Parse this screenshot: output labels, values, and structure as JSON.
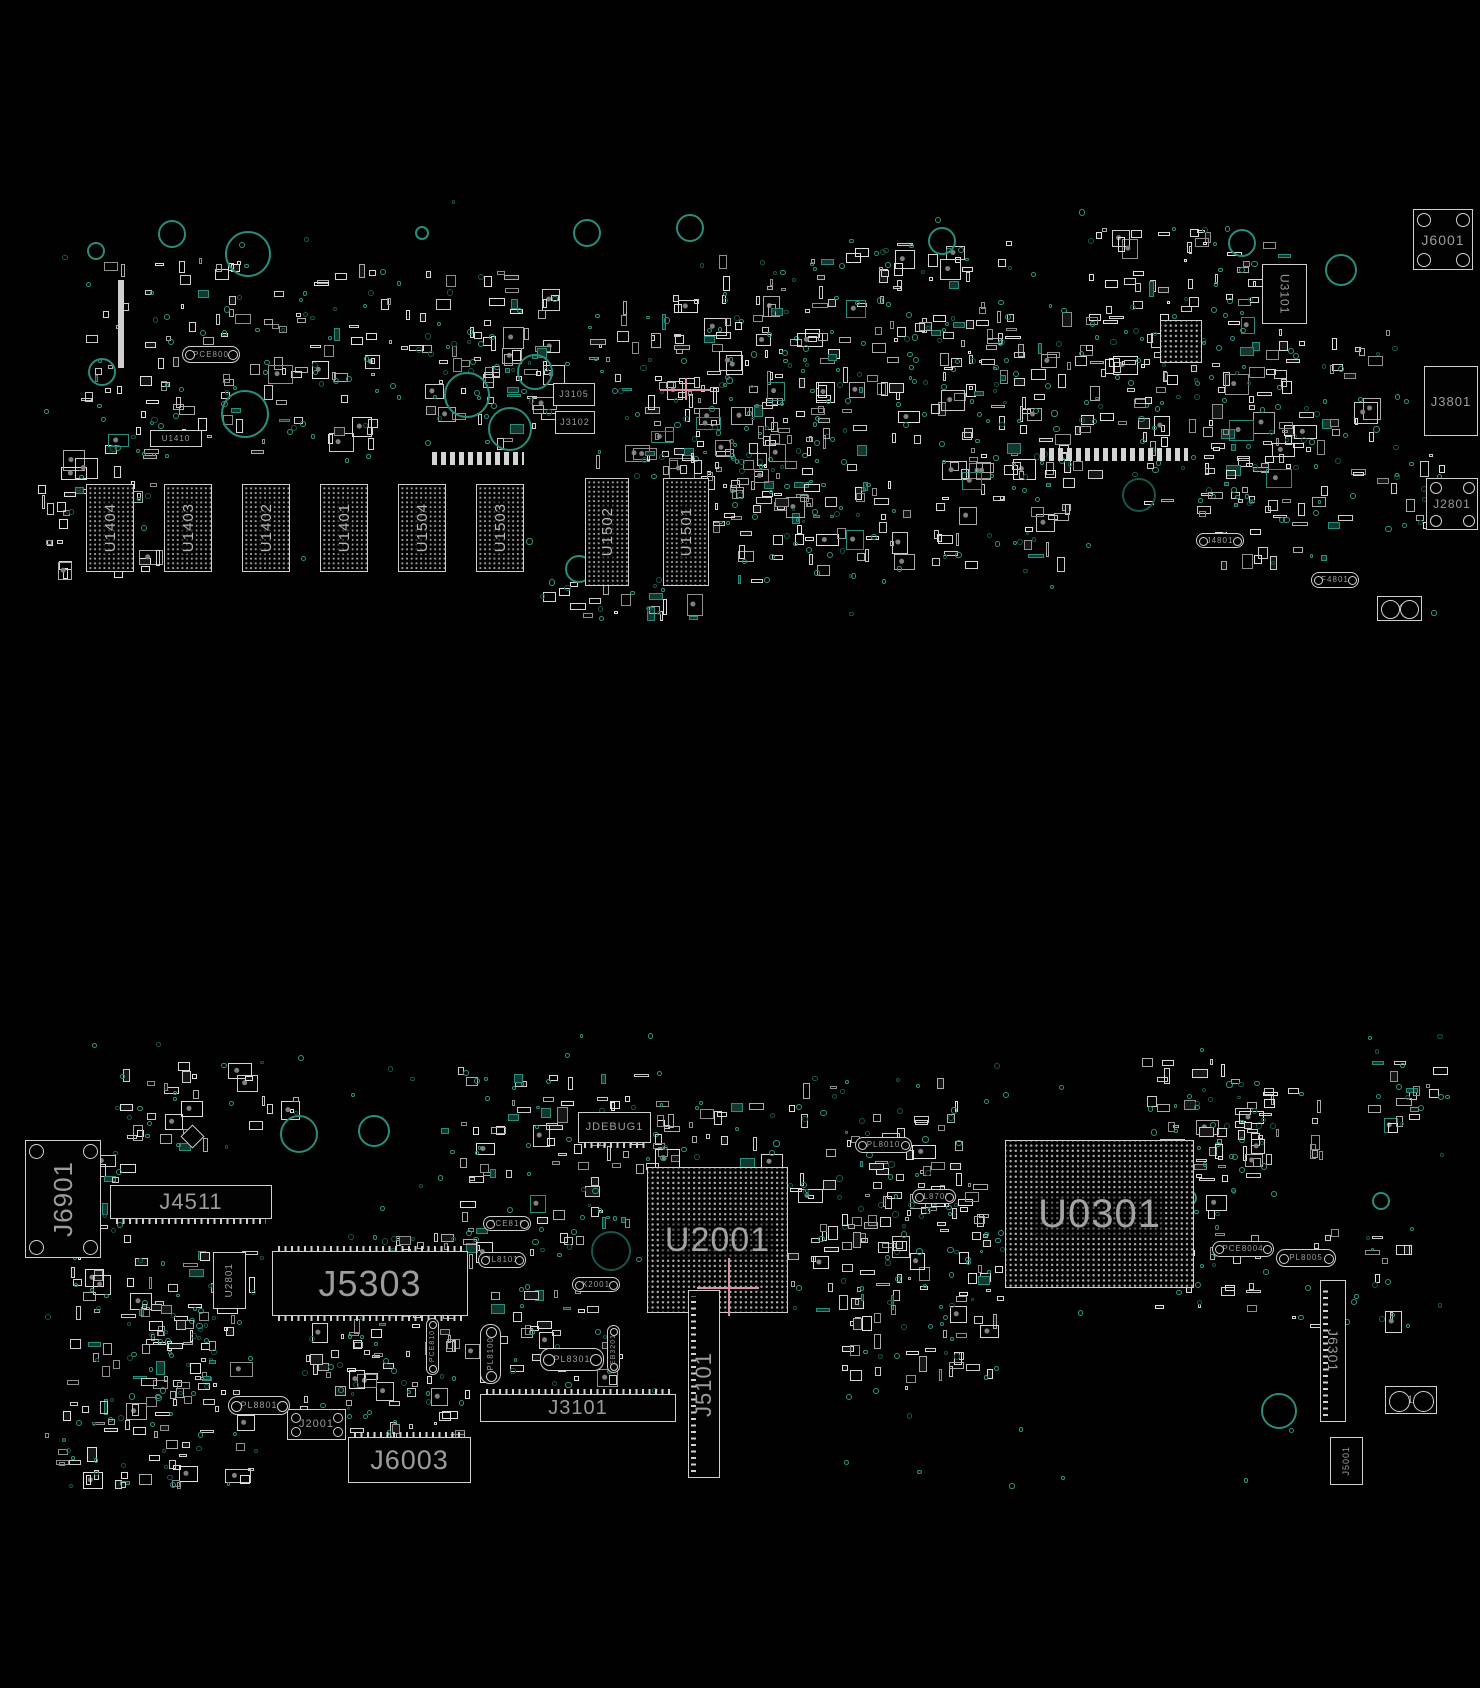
{
  "meta": {
    "background": "#010101",
    "image_kind": "pcb-boardview-two-sides"
  },
  "colors": {
    "silkscreen": "#cfcfcf",
    "label_gray": "#9c9c9c",
    "label_bright": "#b6b6b6",
    "via_teal": "#2f9482",
    "via_teal_dark": "#17564a",
    "hole_teal": "#2a8c7a",
    "crosshair_pink": "#d893a0",
    "background": "#010101"
  },
  "scatter_seed": 42,
  "boards": [
    {
      "name": "top-board-view",
      "components": [
        {
          "label": "J6001",
          "t": "sock",
          "x": 1413,
          "y": 209,
          "w": 60,
          "h": 61,
          "s": 14,
          "dir": "h"
        },
        {
          "label": "U3101",
          "t": "box",
          "x": 1262,
          "y": 264,
          "w": 45,
          "h": 60,
          "s": 12,
          "dir": "vd"
        },
        {
          "label": "",
          "t": "bga",
          "x": 1160,
          "y": 320,
          "w": 42,
          "h": 43,
          "s": 0,
          "dir": "h"
        },
        {
          "label": "J3801",
          "t": "box",
          "x": 1424,
          "y": 366,
          "w": 54,
          "h": 70,
          "s": 13,
          "dir": "h"
        },
        {
          "label": "J2801",
          "t": "sock",
          "x": 1426,
          "y": 478,
          "w": 52,
          "h": 52,
          "s": 12,
          "dir": "h"
        },
        {
          "label": "F4801",
          "t": "oval",
          "x": 1311,
          "y": 572,
          "w": 48,
          "h": 16,
          "s": 8,
          "dir": "h"
        },
        {
          "label": "HP404",
          "t": "jack",
          "x": 1377,
          "y": 596,
          "w": 45,
          "h": 25,
          "s": 10,
          "dir": "h"
        },
        {
          "label": "J4801",
          "t": "oval",
          "x": 1196,
          "y": 533,
          "w": 48,
          "h": 15,
          "s": 8,
          "dir": "h"
        },
        {
          "label": "PCE800",
          "t": "oval",
          "x": 182,
          "y": 346,
          "w": 58,
          "h": 17,
          "s": 8,
          "dir": "h"
        },
        {
          "label": "U1410",
          "t": "box",
          "x": 150,
          "y": 430,
          "w": 52,
          "h": 17,
          "s": 8,
          "dir": "h"
        },
        {
          "label": "J3105",
          "t": "box",
          "x": 553,
          "y": 383,
          "w": 42,
          "h": 23,
          "s": 9,
          "dir": "h"
        },
        {
          "label": "J3102",
          "t": "box",
          "x": 555,
          "y": 411,
          "w": 40,
          "h": 23,
          "s": 9,
          "dir": "h"
        },
        {
          "label": "U1404",
          "t": "mem",
          "x": 86,
          "y": 484,
          "w": 48,
          "h": 88,
          "s": 15,
          "dir": "v"
        },
        {
          "label": "U1403",
          "t": "mem",
          "x": 164,
          "y": 484,
          "w": 48,
          "h": 88,
          "s": 15,
          "dir": "v"
        },
        {
          "label": "U1402",
          "t": "mem",
          "x": 242,
          "y": 484,
          "w": 48,
          "h": 88,
          "s": 15,
          "dir": "v"
        },
        {
          "label": "U1401",
          "t": "mem",
          "x": 320,
          "y": 484,
          "w": 48,
          "h": 88,
          "s": 15,
          "dir": "v"
        },
        {
          "label": "U1504",
          "t": "mem",
          "x": 398,
          "y": 484,
          "w": 48,
          "h": 88,
          "s": 15,
          "dir": "v"
        },
        {
          "label": "U1503",
          "t": "mem",
          "x": 476,
          "y": 484,
          "w": 48,
          "h": 88,
          "s": 15,
          "dir": "v"
        },
        {
          "label": "U1502",
          "t": "mem",
          "x": 585,
          "y": 478,
          "w": 44,
          "h": 108,
          "s": 15,
          "dir": "v"
        },
        {
          "label": "U1501",
          "t": "mem",
          "x": 663,
          "y": 478,
          "w": 46,
          "h": 108,
          "s": 15,
          "dir": "v"
        },
        {
          "label": "",
          "t": "bar",
          "x": 118,
          "y": 280,
          "w": 6,
          "h": 88,
          "s": 0,
          "dir": "h"
        },
        {
          "label": "",
          "t": "pinstrip",
          "x": 432,
          "y": 452,
          "w": 92,
          "h": 13,
          "s": 0,
          "dir": "h"
        },
        {
          "label": "",
          "t": "pinstrip",
          "x": 1040,
          "y": 448,
          "w": 148,
          "h": 13,
          "s": 0,
          "dir": "h"
        },
        {
          "label": "",
          "t": "cross",
          "x": 660,
          "y": 378,
          "w": 50,
          "h": 22,
          "s": 0,
          "dir": "h"
        }
      ],
      "holes": [
        {
          "x": 94,
          "y": 249,
          "r": 7
        },
        {
          "x": 170,
          "y": 232,
          "r": 12
        },
        {
          "x": 246,
          "y": 252,
          "r": 21
        },
        {
          "x": 420,
          "y": 231,
          "r": 5
        },
        {
          "x": 533,
          "y": 370,
          "r": 16
        },
        {
          "x": 585,
          "y": 231,
          "r": 12
        },
        {
          "x": 688,
          "y": 226,
          "r": 12
        },
        {
          "x": 940,
          "y": 239,
          "r": 12
        },
        {
          "x": 1240,
          "y": 241,
          "r": 12
        },
        {
          "x": 1339,
          "y": 268,
          "r": 14
        },
        {
          "x": 100,
          "y": 370,
          "r": 12
        },
        {
          "x": 243,
          "y": 412,
          "r": 22
        },
        {
          "x": 465,
          "y": 393,
          "r": 21
        },
        {
          "x": 508,
          "y": 427,
          "r": 20
        },
        {
          "x": 577,
          "y": 567,
          "r": 12
        },
        {
          "x": 1137,
          "y": 493,
          "r": 15,
          "dark": true
        }
      ],
      "clusters": [
        {
          "x": 80,
          "y": 255,
          "w": 300,
          "h": 210,
          "n": 100,
          "v": 50
        },
        {
          "x": 360,
          "y": 270,
          "w": 200,
          "h": 130,
          "n": 45,
          "v": 20
        },
        {
          "x": 425,
          "y": 325,
          "w": 140,
          "h": 125,
          "n": 28,
          "v": 14
        },
        {
          "x": 588,
          "y": 295,
          "w": 260,
          "h": 185,
          "n": 85,
          "v": 45
        },
        {
          "x": 685,
          "y": 380,
          "w": 185,
          "h": 145,
          "n": 45,
          "v": 28
        },
        {
          "x": 838,
          "y": 235,
          "w": 190,
          "h": 210,
          "n": 60,
          "v": 32
        },
        {
          "x": 928,
          "y": 295,
          "w": 265,
          "h": 185,
          "n": 90,
          "v": 45
        },
        {
          "x": 1085,
          "y": 225,
          "w": 215,
          "h": 170,
          "n": 60,
          "v": 28
        },
        {
          "x": 1125,
          "y": 355,
          "w": 180,
          "h": 155,
          "n": 45,
          "v": 22
        },
        {
          "x": 38,
          "y": 445,
          "w": 125,
          "h": 135,
          "n": 32,
          "v": 14
        },
        {
          "x": 690,
          "y": 435,
          "w": 125,
          "h": 150,
          "n": 38,
          "v": 20
        },
        {
          "x": 790,
          "y": 478,
          "w": 125,
          "h": 105,
          "n": 22,
          "v": 12
        },
        {
          "x": 928,
          "y": 455,
          "w": 170,
          "h": 125,
          "n": 32,
          "v": 16
        },
        {
          "x": 1188,
          "y": 438,
          "w": 145,
          "h": 135,
          "n": 30,
          "v": 15
        },
        {
          "x": 538,
          "y": 578,
          "w": 165,
          "h": 45,
          "n": 16,
          "v": 9
        },
        {
          "x": 1278,
          "y": 328,
          "w": 125,
          "h": 125,
          "n": 22,
          "v": 11
        },
        {
          "x": 700,
          "y": 255,
          "w": 140,
          "h": 120,
          "n": 30,
          "v": 16
        },
        {
          "x": 1300,
          "y": 440,
          "w": 170,
          "h": 90,
          "n": 18,
          "v": 10
        },
        {
          "x": 35,
          "y": 195,
          "w": 1410,
          "h": 430,
          "n": 0,
          "v": 70
        }
      ]
    },
    {
      "name": "bottom-board-view",
      "components": [
        {
          "label": "J6901",
          "t": "sock",
          "x": 25,
          "y": 1140,
          "w": 76,
          "h": 118,
          "s": 26,
          "dir": "v"
        },
        {
          "label": "J4511",
          "t": "connh",
          "x": 110,
          "y": 1185,
          "w": 162,
          "h": 34,
          "s": 22,
          "dir": "h",
          "ticks": "bot"
        },
        {
          "label": "U2801",
          "t": "box",
          "x": 213,
          "y": 1252,
          "w": 33,
          "h": 57,
          "s": 10,
          "dir": "v"
        },
        {
          "label": "J5303",
          "t": "connh",
          "x": 272,
          "y": 1251,
          "w": 196,
          "h": 65,
          "s": 36,
          "dir": "h",
          "ticks": "topbot"
        },
        {
          "label": "JDEBUG1",
          "t": "connh",
          "x": 578,
          "y": 1112,
          "w": 73,
          "h": 31,
          "s": 11,
          "dir": "h",
          "ticks": "bot"
        },
        {
          "label": "U2001",
          "t": "bga",
          "x": 647,
          "y": 1167,
          "w": 141,
          "h": 146,
          "s": 34,
          "dir": "h"
        },
        {
          "label": "U0301",
          "t": "bga",
          "x": 1005,
          "y": 1140,
          "w": 189,
          "h": 148,
          "s": 40,
          "dir": "h"
        },
        {
          "label": "PL8010",
          "t": "oval",
          "x": 855,
          "y": 1137,
          "w": 57,
          "h": 16,
          "s": 8,
          "dir": "h"
        },
        {
          "label": "PL8700",
          "t": "oval",
          "x": 912,
          "y": 1189,
          "w": 44,
          "h": 15,
          "s": 8,
          "dir": "h"
        },
        {
          "label": "PCE810",
          "t": "oval",
          "x": 483,
          "y": 1216,
          "w": 48,
          "h": 15,
          "s": 8,
          "dir": "h"
        },
        {
          "label": "PL8101",
          "t": "oval",
          "x": 478,
          "y": 1252,
          "w": 48,
          "h": 16,
          "s": 8,
          "dir": "h"
        },
        {
          "label": "PCE810",
          "t": "voval",
          "x": 426,
          "y": 1318,
          "w": 13,
          "h": 57,
          "s": 7,
          "dir": "v"
        },
        {
          "label": "EB3201",
          "t": "voval",
          "x": 607,
          "y": 1325,
          "w": 13,
          "h": 48,
          "s": 7,
          "dir": "v"
        },
        {
          "label": "X2001",
          "t": "oval",
          "x": 572,
          "y": 1277,
          "w": 48,
          "h": 15,
          "s": 8,
          "dir": "h"
        },
        {
          "label": "PL8100",
          "t": "voval",
          "x": 480,
          "y": 1324,
          "w": 21,
          "h": 60,
          "s": 8,
          "dir": "v"
        },
        {
          "label": "PL8301",
          "t": "oval",
          "x": 540,
          "y": 1348,
          "w": 64,
          "h": 23,
          "s": 9,
          "dir": "h"
        },
        {
          "label": "J3101",
          "t": "connh",
          "x": 480,
          "y": 1394,
          "w": 196,
          "h": 28,
          "s": 20,
          "dir": "h",
          "ticks": "top"
        },
        {
          "label": "J5101",
          "t": "connv",
          "x": 688,
          "y": 1290,
          "w": 32,
          "h": 188,
          "s": 22,
          "dir": "v"
        },
        {
          "label": "J2001",
          "t": "sock",
          "x": 287,
          "y": 1409,
          "w": 59,
          "h": 31,
          "s": 11,
          "dir": "h"
        },
        {
          "label": "PL8801",
          "t": "oval",
          "x": 228,
          "y": 1396,
          "w": 62,
          "h": 19,
          "s": 9,
          "dir": "h"
        },
        {
          "label": "J6003",
          "t": "connh",
          "x": 348,
          "y": 1437,
          "w": 123,
          "h": 46,
          "s": 27,
          "dir": "h",
          "ticks": "top"
        },
        {
          "label": "J6301",
          "t": "connv",
          "x": 1320,
          "y": 1280,
          "w": 26,
          "h": 142,
          "s": 14,
          "dir": "vd"
        },
        {
          "label": "PCE8004",
          "t": "oval",
          "x": 1212,
          "y": 1241,
          "w": 62,
          "h": 16,
          "s": 8,
          "dir": "h"
        },
        {
          "label": "PL8005",
          "t": "oval",
          "x": 1276,
          "y": 1249,
          "w": 60,
          "h": 18,
          "s": 8,
          "dir": "h"
        },
        {
          "label": "J3102",
          "t": "jack",
          "x": 1385,
          "y": 1386,
          "w": 52,
          "h": 28,
          "s": 11,
          "dir": "h"
        },
        {
          "label": "J5001",
          "t": "box",
          "x": 1330,
          "y": 1437,
          "w": 33,
          "h": 48,
          "s": 9,
          "dir": "v"
        },
        {
          "label": "",
          "t": "diamond",
          "x": 184,
          "y": 1128,
          "w": 17,
          "h": 17,
          "s": 0,
          "dir": "h"
        },
        {
          "label": "",
          "t": "cross",
          "x": 697,
          "y": 1258,
          "w": 62,
          "h": 58,
          "s": 0,
          "dir": "h"
        }
      ],
      "holes": [
        {
          "x": 297,
          "y": 1132,
          "r": 17
        },
        {
          "x": 372,
          "y": 1129,
          "r": 14
        },
        {
          "x": 609,
          "y": 1249,
          "r": 18,
          "dark": true
        },
        {
          "x": 1277,
          "y": 1409,
          "r": 16
        },
        {
          "x": 1379,
          "y": 1199,
          "r": 7
        },
        {
          "x": 1187,
          "y": 1196,
          "r": 6
        }
      ],
      "clusters": [
        {
          "x": 60,
          "y": 1248,
          "w": 205,
          "h": 185,
          "n": 75,
          "v": 38
        },
        {
          "x": 115,
          "y": 1058,
          "w": 185,
          "h": 95,
          "n": 28,
          "v": 14
        },
        {
          "x": 295,
          "y": 1318,
          "w": 185,
          "h": 125,
          "n": 55,
          "v": 28
        },
        {
          "x": 438,
          "y": 1058,
          "w": 225,
          "h": 205,
          "n": 75,
          "v": 38
        },
        {
          "x": 618,
          "y": 1098,
          "w": 165,
          "h": 72,
          "n": 26,
          "v": 13
        },
        {
          "x": 788,
          "y": 1078,
          "w": 205,
          "h": 235,
          "n": 75,
          "v": 38
        },
        {
          "x": 832,
          "y": 1188,
          "w": 175,
          "h": 205,
          "n": 55,
          "v": 28
        },
        {
          "x": 1140,
          "y": 1058,
          "w": 125,
          "h": 125,
          "n": 32,
          "v": 16
        },
        {
          "x": 1198,
          "y": 1078,
          "w": 125,
          "h": 105,
          "n": 26,
          "v": 13
        },
        {
          "x": 1148,
          "y": 1188,
          "w": 125,
          "h": 125,
          "n": 32,
          "v": 16
        },
        {
          "x": 1288,
          "y": 1228,
          "w": 125,
          "h": 105,
          "n": 14,
          "v": 8
        },
        {
          "x": 38,
          "y": 1418,
          "w": 225,
          "h": 72,
          "n": 32,
          "v": 16
        },
        {
          "x": 348,
          "y": 1228,
          "w": 125,
          "h": 92,
          "n": 26,
          "v": 13
        },
        {
          "x": 478,
          "y": 1278,
          "w": 145,
          "h": 112,
          "n": 30,
          "v": 15
        },
        {
          "x": 1348,
          "y": 1058,
          "w": 105,
          "h": 82,
          "n": 16,
          "v": 8
        },
        {
          "x": 60,
          "y": 1150,
          "w": 80,
          "h": 100,
          "n": 12,
          "v": 8
        },
        {
          "x": 140,
          "y": 1300,
          "w": 80,
          "h": 110,
          "n": 25,
          "v": 12
        },
        {
          "x": 855,
          "y": 1160,
          "w": 90,
          "h": 60,
          "n": 16,
          "v": 8
        },
        {
          "x": 25,
          "y": 1030,
          "w": 1440,
          "h": 460,
          "n": 0,
          "v": 80
        }
      ]
    }
  ]
}
